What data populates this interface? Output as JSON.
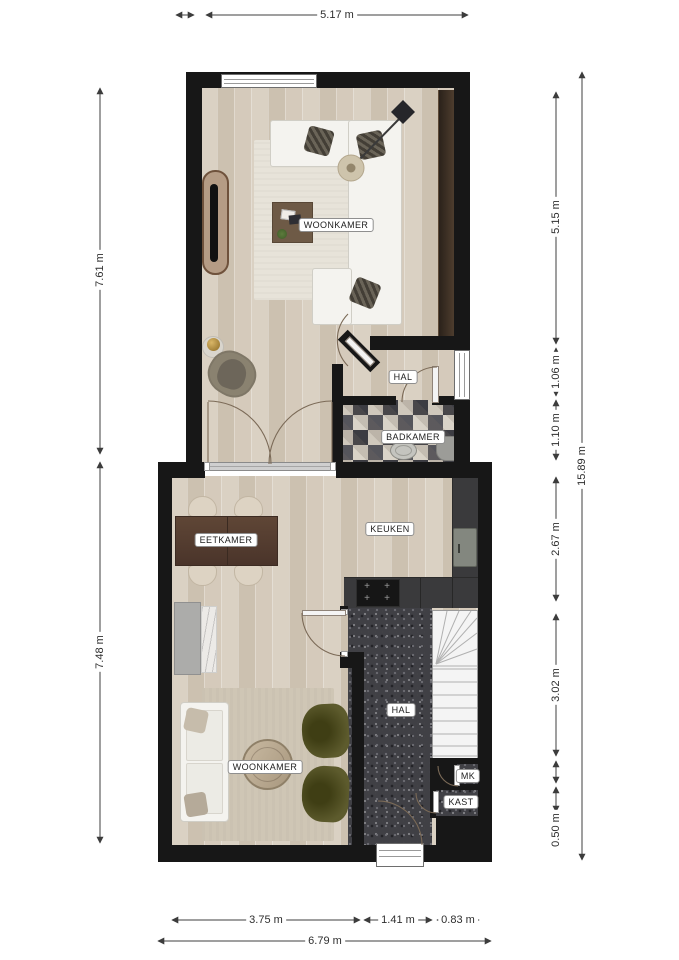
{
  "rooms": {
    "woonkamer_upper": "WOONKAMER",
    "hal_upper": "HAL",
    "badkamer": "BADKAMER",
    "eetkamer": "EETKAMER",
    "keuken": "KEUKEN",
    "hal_lower": "HAL",
    "woonkamer_lower": "WOONKAMER",
    "mk": "MK",
    "kast": "KAST"
  },
  "dimensions": {
    "top": {
      "width": "5.17 m"
    },
    "left": {
      "upper_height": "7.61 m",
      "lower_height": "7.48 m"
    },
    "right": {
      "segments": [
        "5.15 m",
        "1.06 m",
        "1.10 m",
        "2.67 m",
        "3.02 m",
        "0.50 m"
      ],
      "total_height": "15.89 m"
    },
    "bottom": {
      "segments": [
        "3.75 m",
        "1.41 m",
        "0.83 m"
      ],
      "total_width": "6.79 m"
    }
  },
  "colors": {
    "wall": "#171717",
    "wood_floor": "#d6ccbd",
    "hall_carpet": "#404045",
    "kitchen_counter": "#3a3a3c",
    "armchair_green": "#5d5b2d",
    "dining_table_brown": "#5f4636"
  }
}
